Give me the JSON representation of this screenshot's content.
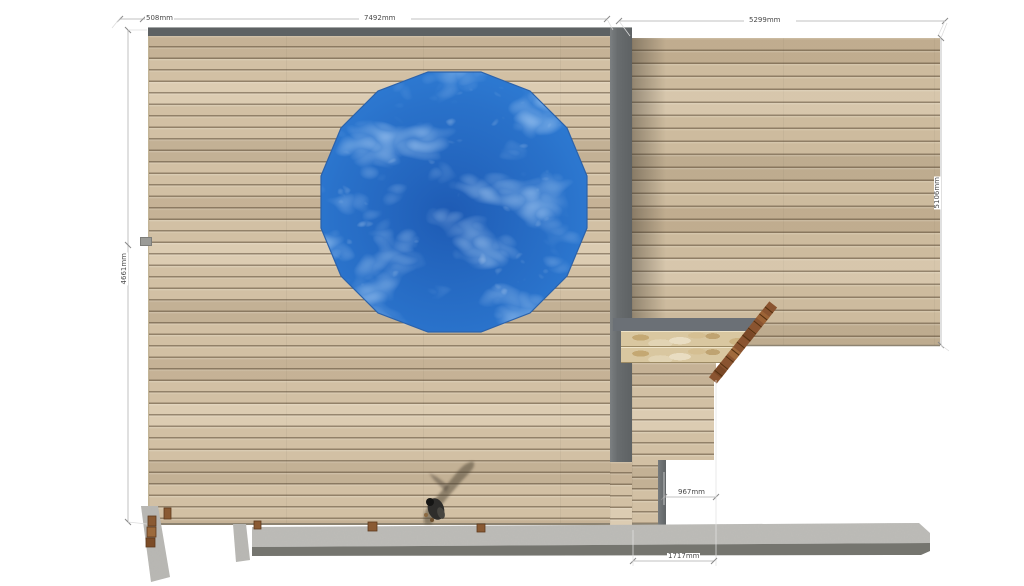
{
  "viewport": {
    "background": "#ffffff"
  },
  "dimensions": {
    "top_left_offset": "508mm",
    "top_main_width": "7492mm",
    "top_right_width": "5299mm",
    "left_height": "4661mm",
    "right_height": "5106mm",
    "walkway_width": "967mm",
    "bottom_width": "1717mm"
  },
  "scene": {
    "objects": [
      "upper-deck",
      "lower-deck",
      "circular-pool",
      "retaining-wall",
      "travertine-steps",
      "stair-edge-board",
      "walkway",
      "person",
      "person-shadow",
      "concrete-base-wall",
      "concrete-pillars",
      "timber-posts"
    ],
    "colors": {
      "deck_plank": "#d2c0a4",
      "deck_gap": "#8f7d60",
      "wall_gray": "#686c6e",
      "pool_blue": "#2e7bd3",
      "travertine": "#d9c7a0",
      "timber": "#8a5430",
      "concrete": "#bdbcb8",
      "dimension_line": "#ababab",
      "dimension_text": "#4a4a4a"
    }
  }
}
